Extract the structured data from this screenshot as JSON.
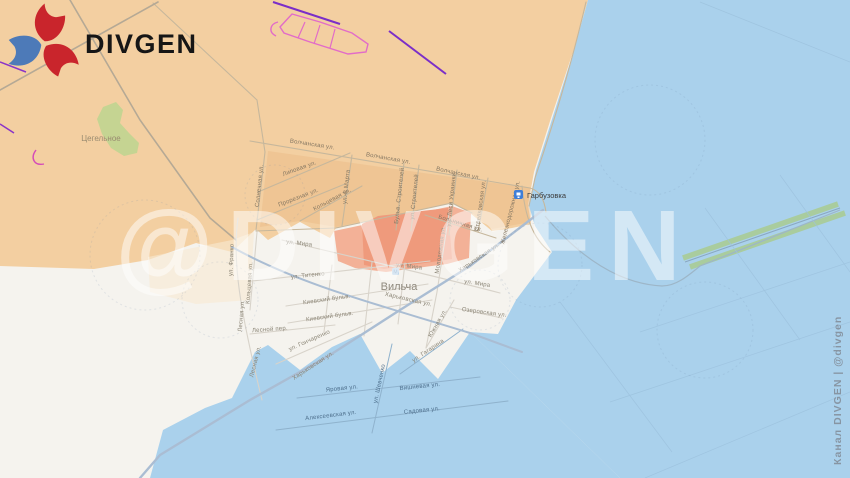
{
  "logo": {
    "brand": "DIVGEN"
  },
  "watermark": {
    "big": "@DIVGEN",
    "channel": "Канал DIVGEN | @divgen"
  },
  "places": {
    "town": "Вильча",
    "hamlet": "Цегельное",
    "station": "Гарбузовка"
  },
  "streets": {
    "volchanskaya": "Волчанская ул.",
    "solnechnaya": "Солнечная ул.",
    "lipovaya": "Липовая ул.",
    "proreznaya": "Прорезная ул.",
    "koltsevaya": "Кольцевая ул.",
    "marta8": "ул. 8 Марта",
    "bulv_stroiteley": "Бульв. Строителей",
    "stroiteley": "ул. Строителей",
    "lesi_ukrainki": "ул. Леси Украинки",
    "molodezhnaya": "Молодежная ул.",
    "bolnichnaya": "Больничная ул.",
    "strelkovskaya": "Стрелковская ул.",
    "zheleznodorozhnaya": "Железнодорожная ул.",
    "kharkovskaya": "Харьковская ул.",
    "mira": "ул. Мира",
    "titenko": "ул. Титенко",
    "kievsky_bulv": "Киевский бульв.",
    "lesnaya": "Лесная ул.",
    "lesnoy_per": "Лесной пер.",
    "goncharenko": "ул. Гончаренко",
    "franko": "ул. Франко",
    "ozerovskaya": "Озеровская ул.",
    "yuzhnaya": "Южная ул.",
    "shevchenko": "ул. Шевченко",
    "yarovaya": "Яровая ул.",
    "vishnevaya": "Вишневая ул.",
    "alekseevskaya": "Алексеевская ул.",
    "sadovaya": "Садовая ул.",
    "gagarina": "ул. Гагарина"
  },
  "colors": {
    "occupied_tan": "#f3cfa1",
    "contested_red": "#ef9a7c",
    "water_blue": "#aad1ec",
    "land_white": "#f5f3ee",
    "vegetation_green": "#c5d492",
    "trench_violet": "#7b2ec8",
    "trench_pink": "#e26cc8",
    "logo_red": "#c9252c",
    "logo_blue": "#4d7ab8"
  }
}
